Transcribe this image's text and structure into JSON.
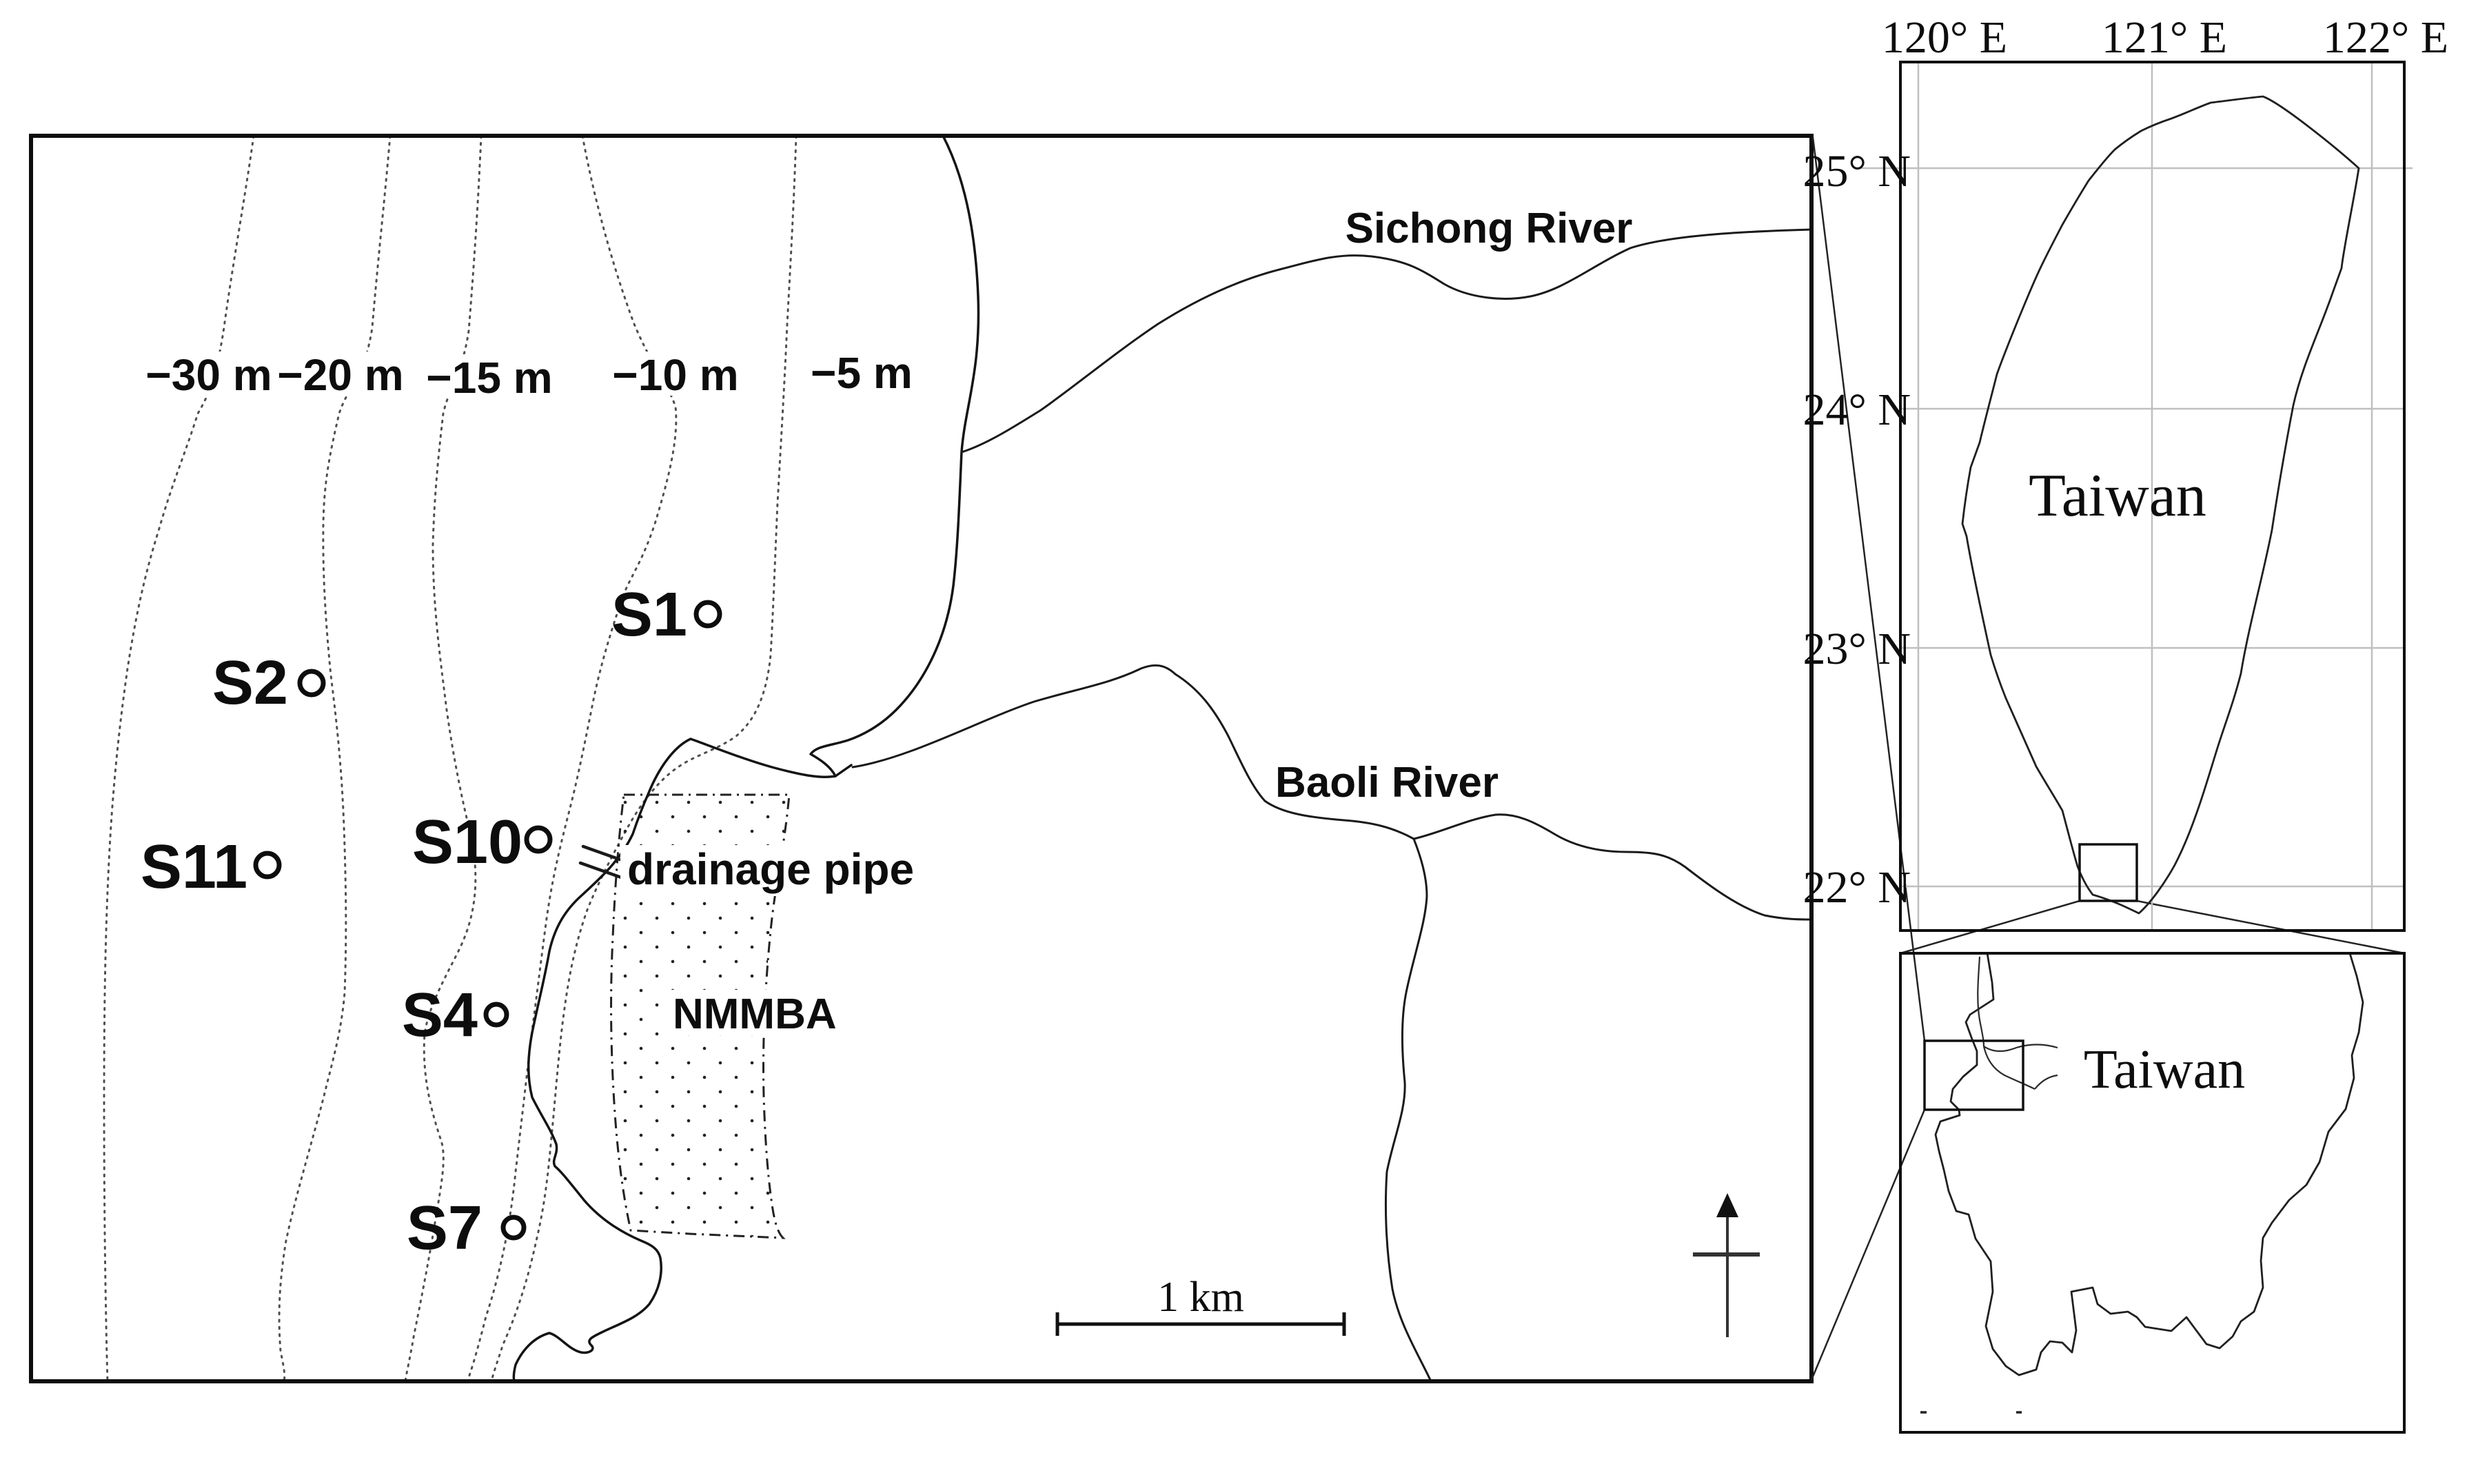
{
  "colors": {
    "ink": "#0d0d0d",
    "contour_gray": "#4f4f4f",
    "grid_gray": "#bfbfbf",
    "background": "#ffffff"
  },
  "main_map": {
    "contour_labels": [
      "−30 m",
      "−20 m",
      "−15 m",
      "−10 m",
      "−5 m"
    ],
    "sichong_river_label": "Sichong River",
    "baoli_river_label": "Baoli River",
    "drainage_pipe_label": "drainage pipe",
    "area_label": "NMMBA",
    "stations": [
      {
        "label": "S1"
      },
      {
        "label": "S2"
      },
      {
        "label": "S11"
      },
      {
        "label": "S10"
      },
      {
        "label": "S4"
      },
      {
        "label": "S7"
      }
    ],
    "scale_bar_label": "1 km"
  },
  "inset_overview": {
    "region_label": "Taiwan",
    "lon_labels": [
      "120° E",
      "121° E",
      "122° E"
    ],
    "lat_labels": [
      "25° N",
      "24° N",
      "23° N",
      "22° N"
    ]
  },
  "inset_detail": {
    "region_label": "Taiwan"
  },
  "map_data": {
    "type": "study_site_map",
    "stations": [
      "S1",
      "S2",
      "S4",
      "S7",
      "S10",
      "S11"
    ],
    "depth_contours_m": [
      -30,
      -20,
      -15,
      -10,
      -5
    ],
    "rivers": [
      "Sichong River",
      "Baoli River"
    ],
    "area": "NMMBA",
    "point_feature": "drainage pipe",
    "scale_bar": "1 km",
    "overview_grid": {
      "longitudes": [
        "120° E",
        "121° E",
        "122° E"
      ],
      "latitudes": [
        "25° N",
        "24° N",
        "23° N",
        "22° N"
      ]
    }
  }
}
